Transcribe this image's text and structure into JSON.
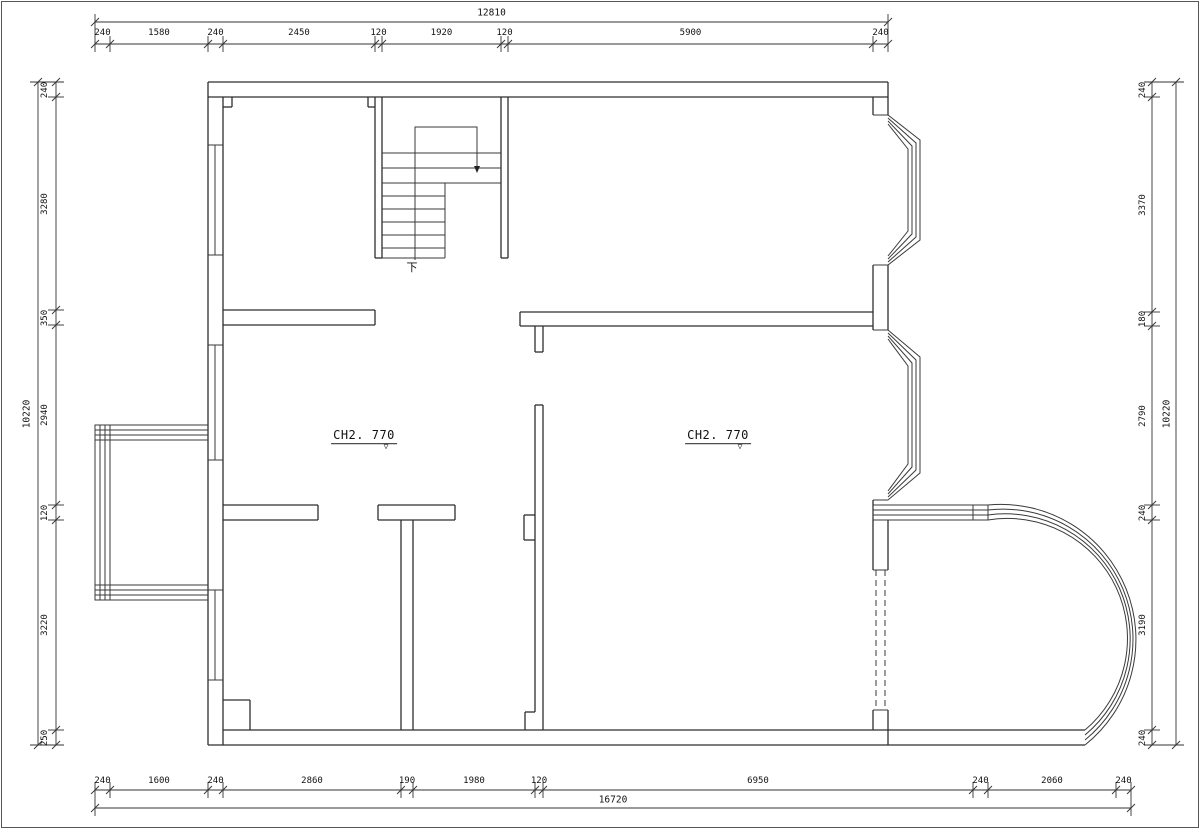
{
  "page": {
    "background": "#ffffff",
    "line_color": "#2e2e2e",
    "frame_color": "#555555"
  },
  "room_labels": [
    {
      "text": "CH2. 770",
      "x": 364,
      "y": 437
    },
    {
      "text": "CH2. 770",
      "x": 718,
      "y": 437
    }
  ],
  "level_marker_icon": "▽",
  "stair_label": {
    "text": "下",
    "x": 412,
    "y": 267
  },
  "dim_sides": [
    {
      "side": "top",
      "axis": "x",
      "chain_pos": 44,
      "label_pos": 33,
      "overall_pos": 22,
      "overall_label_pos": 13,
      "boundaries": [
        95,
        110,
        208,
        223,
        375,
        382,
        501,
        508,
        873,
        888
      ],
      "labels": [
        "240",
        "1580",
        "240",
        "2450",
        "120",
        "1920",
        "120",
        "5900",
        "240"
      ],
      "overall_label": "12810"
    },
    {
      "side": "bottom",
      "axis": "x",
      "chain_pos": 790,
      "label_pos": 781,
      "overall_pos": 808,
      "overall_label_pos": 800,
      "boundaries": [
        95,
        110,
        208,
        223,
        401,
        413,
        535,
        543,
        973,
        988,
        1116,
        1131
      ],
      "labels": [
        "240",
        "1600",
        "240",
        "2860",
        "190",
        "1980",
        "120",
        "6950",
        "240",
        "2060",
        "240"
      ],
      "overall_label": "16720"
    },
    {
      "side": "left",
      "axis": "y",
      "chain_pos": 56,
      "label_pos": 45,
      "overall_pos": 38,
      "overall_label_pos": 27,
      "boundaries": [
        82,
        97,
        310,
        325,
        505,
        520,
        730,
        745
      ],
      "labels": [
        "240",
        "3280",
        "350",
        "2940",
        "120",
        "3220",
        "250"
      ],
      "overall_label": "10220"
    },
    {
      "side": "right",
      "axis": "y",
      "chain_pos": 1152,
      "label_pos": 1143,
      "overall_pos": 1176,
      "overall_label_pos": 1167,
      "boundaries": [
        82,
        97,
        312,
        326,
        505,
        520,
        730,
        745
      ],
      "labels": [
        "240",
        "3370",
        "180",
        "2790",
        "240",
        "3190",
        "240"
      ],
      "overall_label": "10220"
    }
  ]
}
